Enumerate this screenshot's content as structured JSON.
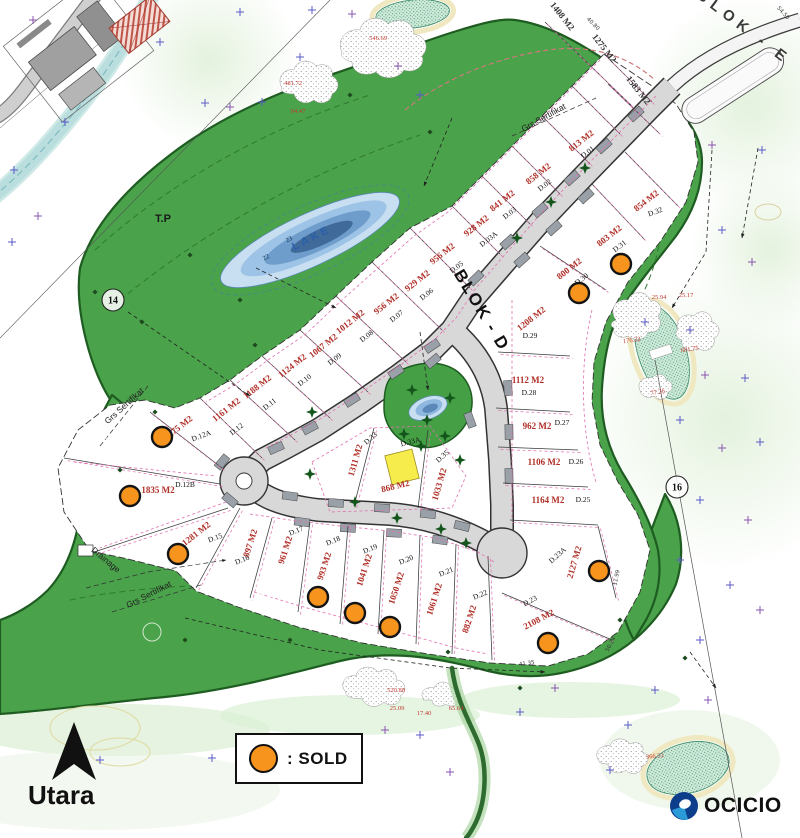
{
  "legend": {
    "sold_label": ": SOLD"
  },
  "compass": {
    "label": "Utara"
  },
  "brand": {
    "name": "OCICIO"
  },
  "map": {
    "colors": {
      "green": "#4aa24a",
      "green_dark": "#1e5c21",
      "road": "#d8d8d8",
      "sold": "#f7941d",
      "area_text": "#b03028",
      "pink": "#e070b0",
      "lake_deep": "#3f6a99",
      "building_yellow": "#f6ec4c",
      "cross_blue": "#5b5bc8",
      "cross_purple": "#8a55b0"
    },
    "labels": [
      {
        "t": "BLOK - D",
        "x": 477,
        "y": 313,
        "r": 59,
        "s": 17,
        "c": "#111",
        "w": 700,
        "ls": 2
      },
      {
        "t": "BLOK - E",
        "x": 741,
        "y": 31,
        "r": 37,
        "s": 15,
        "c": "#3a3a3a",
        "w": 700,
        "ls": 6
      },
      {
        "t": "LAKE",
        "x": 313,
        "y": 241,
        "r": -27,
        "s": 11,
        "c": "#2b5fa8",
        "w": 700,
        "ls": 3
      },
      {
        "t": "T.P",
        "x": 163,
        "y": 222,
        "r": 0,
        "s": 11,
        "c": "#1a1a1a",
        "w": 700,
        "ls": 0
      },
      {
        "t": "Grs Sertifikat",
        "x": 545,
        "y": 120,
        "r": -29,
        "s": 8.5,
        "c": "#222",
        "w": 400,
        "ls": 0
      },
      {
        "t": "Grs Sertifikat",
        "x": 126,
        "y": 408,
        "r": -42,
        "s": 8.5,
        "c": "#222",
        "w": 400,
        "ls": 0
      },
      {
        "t": "Grs Sertifikat",
        "x": 150,
        "y": 597,
        "r": -27,
        "s": 8.5,
        "c": "#222",
        "w": 400,
        "ls": 0
      },
      {
        "t": "Drainage",
        "x": 104,
        "y": 562,
        "r": 40,
        "s": 8.5,
        "c": "#222",
        "w": 400,
        "ls": 0
      }
    ],
    "plots": [
      {
        "id": "D.01",
        "area": "813 M2",
        "ax": 583,
        "ay": 143,
        "ar": -38,
        "ix": 589,
        "iy": 154,
        "ir": -38,
        "sold": false
      },
      {
        "id": "D.02",
        "area": "858 M2",
        "ax": 540,
        "ay": 176,
        "ar": -38,
        "ix": 546,
        "iy": 187,
        "ir": -38,
        "sold": false
      },
      {
        "id": "D.03",
        "area": "841 M2",
        "ax": 504,
        "ay": 203,
        "ar": -38,
        "ix": 511,
        "iy": 215,
        "ir": -38,
        "sold": false
      },
      {
        "id": "D.03A",
        "area": "928 M2",
        "ax": 478,
        "ay": 228,
        "ar": -38,
        "ix": 490,
        "iy": 241,
        "ir": -38,
        "sold": false
      },
      {
        "id": "D.05",
        "area": "956 M2",
        "ax": 444,
        "ay": 256,
        "ar": -38,
        "ix": 458,
        "iy": 269,
        "ir": -38,
        "sold": false
      },
      {
        "id": "D.06",
        "area": "929 M2",
        "ax": 419,
        "ay": 283,
        "ar": -38,
        "ix": 428,
        "iy": 296,
        "ir": -38,
        "sold": false
      },
      {
        "id": "D.07",
        "area": "956 M2",
        "ax": 388,
        "ay": 306,
        "ar": -38,
        "ix": 398,
        "iy": 318,
        "ir": -38,
        "sold": false
      },
      {
        "id": "D.08",
        "area": "1012 M2",
        "ax": 352,
        "ay": 324,
        "ar": -38,
        "ix": 368,
        "iy": 338,
        "ir": -38,
        "sold": false
      },
      {
        "id": "D.09",
        "area": "1067 M2",
        "ax": 325,
        "ay": 348,
        "ar": -38,
        "ix": 336,
        "iy": 361,
        "ir": -38,
        "sold": false
      },
      {
        "id": "D.10",
        "area": "1124 M2",
        "ax": 294,
        "ay": 368,
        "ar": -38,
        "ix": 306,
        "iy": 382,
        "ir": -38,
        "sold": false
      },
      {
        "id": "D.11",
        "area": "1188 M2",
        "ax": 259,
        "ay": 389,
        "ar": -38,
        "ix": 271,
        "iy": 406,
        "ir": -38,
        "sold": false
      },
      {
        "id": "D.12",
        "area": "1161 M2",
        "ax": 228,
        "ay": 412,
        "ar": -38,
        "ix": 238,
        "iy": 431,
        "ir": -38,
        "sold": false
      },
      {
        "id": "D.12A",
        "area": "1275 M2",
        "ax": 180,
        "ay": 430,
        "ar": -38,
        "ix": 202,
        "iy": 438,
        "ir": -20,
        "sold": true,
        "sx": 162,
        "sy": 437
      },
      {
        "id": "D.12B",
        "area": "1835 M2",
        "ax": 158,
        "ay": 493,
        "ar": 0,
        "ix": 185,
        "iy": 487,
        "ir": 0,
        "sold": true,
        "sx": 130,
        "sy": 496
      },
      {
        "id": "D.15",
        "area": "1281 M2",
        "ax": 198,
        "ay": 536,
        "ar": -38,
        "ix": 216,
        "iy": 540,
        "ir": -20,
        "sold": true,
        "sx": 178,
        "sy": 554
      },
      {
        "id": "D.16",
        "area": "897 M2",
        "ax": 253,
        "ay": 544,
        "ar": -72,
        "ix": 243,
        "iy": 562,
        "ir": -22,
        "sold": false
      },
      {
        "id": "D.17",
        "area": "961 M2",
        "ax": 288,
        "ay": 551,
        "ar": -72,
        "ix": 297,
        "iy": 533,
        "ir": -22,
        "sold": false
      },
      {
        "id": "D.18",
        "area": "993 M2",
        "ax": 327,
        "ay": 567,
        "ar": -72,
        "ix": 334,
        "iy": 543,
        "ir": -22,
        "sold": true,
        "sx": 318,
        "sy": 597
      },
      {
        "id": "D.19",
        "area": "1041 M2",
        "ax": 367,
        "ay": 571,
        "ar": -72,
        "ix": 371,
        "iy": 551,
        "ir": -22,
        "sold": true,
        "sx": 355,
        "sy": 613
      },
      {
        "id": "D.20",
        "area": "1050 M2",
        "ax": 399,
        "ay": 589,
        "ar": -72,
        "ix": 407,
        "iy": 562,
        "ir": -22,
        "sold": true,
        "sx": 390,
        "sy": 627
      },
      {
        "id": "D.21",
        "area": "1061 M2",
        "ax": 437,
        "ay": 600,
        "ar": -72,
        "ix": 447,
        "iy": 574,
        "ir": -22,
        "sold": false
      },
      {
        "id": "D.22",
        "area": "882 M2",
        "ax": 472,
        "ay": 620,
        "ar": -72,
        "ix": 481,
        "iy": 597,
        "ir": -22,
        "sold": false
      },
      {
        "id": "D.23",
        "area": "2108 M2",
        "ax": 540,
        "ay": 622,
        "ar": -28,
        "ix": 531,
        "iy": 603,
        "ir": -28,
        "sold": true,
        "sx": 548,
        "sy": 643
      },
      {
        "id": "D.23A",
        "area": "2127 M2",
        "ax": 577,
        "ay": 563,
        "ar": -74,
        "ix": 559,
        "iy": 557,
        "ir": -42,
        "sold": true,
        "sx": 599,
        "sy": 571
      },
      {
        "id": "D.25",
        "area": "1164 M2",
        "ax": 548,
        "ay": 503,
        "ar": 0,
        "ix": 583,
        "iy": 502,
        "ir": 0,
        "sold": false
      },
      {
        "id": "D.26",
        "area": "1106 M2",
        "ax": 544,
        "ay": 465,
        "ar": 0,
        "ix": 576,
        "iy": 464,
        "ir": 0,
        "sold": false
      },
      {
        "id": "D.27",
        "area": "962 M2",
        "ax": 537,
        "ay": 429,
        "ar": 0,
        "ix": 562,
        "iy": 425,
        "ir": 0,
        "sold": false
      },
      {
        "id": "D.28",
        "area": "1112 M2",
        "ax": 528,
        "ay": 383,
        "ar": 0,
        "ix": 529,
        "iy": 395,
        "ir": 0,
        "sold": false
      },
      {
        "id": "D.29",
        "area": "1208 M2",
        "ax": 533,
        "ay": 321,
        "ar": -38,
        "ix": 530,
        "iy": 338,
        "ir": 0,
        "sold": false
      },
      {
        "id": "D.30",
        "area": "800 M2",
        "ax": 571,
        "ay": 271,
        "ar": -38,
        "ix": 583,
        "iy": 281,
        "ir": -38,
        "sold": true,
        "sx": 579,
        "sy": 293
      },
      {
        "id": "D.31",
        "area": "803 M2",
        "ax": 611,
        "ay": 238,
        "ar": -38,
        "ix": 621,
        "iy": 248,
        "ir": -38,
        "sold": true,
        "sx": 621,
        "sy": 264
      },
      {
        "id": "D.32",
        "area": "854 M2",
        "ax": 648,
        "ay": 203,
        "ar": -38,
        "ix": 656,
        "iy": 214,
        "ir": -20,
        "sold": false
      },
      {
        "id": "D.33",
        "area": "1311 M2",
        "ax": 358,
        "ay": 461,
        "ar": -74,
        "ix": 372,
        "iy": 440,
        "ir": -42,
        "sold": false
      },
      {
        "id": "D.33A",
        "area": "868 M2",
        "ax": 396,
        "ay": 489,
        "ar": -14,
        "ix": 411,
        "iy": 444,
        "ir": -14,
        "sold": false
      },
      {
        "id": "D.35",
        "area": "1033 M2",
        "ax": 442,
        "ay": 485,
        "ar": -74,
        "ix": 444,
        "iy": 458,
        "ir": -42,
        "sold": false
      }
    ],
    "blok_e_plots": [
      {
        "area": "1408 M2",
        "x": 560,
        "y": 18,
        "r": 52
      },
      {
        "area": "1275 M2",
        "x": 602,
        "y": 50,
        "r": 52
      },
      {
        "area": "1583 M2",
        "x": 636,
        "y": 92,
        "r": 52
      }
    ],
    "red_numbers": [
      {
        "t": "546.69",
        "x": 378,
        "y": 40,
        "r": 0
      },
      {
        "t": "481.72",
        "x": 293,
        "y": 85,
        "r": 0
      },
      {
        "t": "94.47",
        "x": 298,
        "y": 113,
        "r": 0
      },
      {
        "t": "25.94",
        "x": 659,
        "y": 299,
        "r": 0
      },
      {
        "t": "25.17",
        "x": 686,
        "y": 297,
        "r": 0
      },
      {
        "t": "176.22",
        "x": 632,
        "y": 342,
        "r": -8
      },
      {
        "t": "681.75",
        "x": 690,
        "y": 351,
        "r": -8
      },
      {
        "t": "77.26",
        "x": 658,
        "y": 394,
        "r": -10
      },
      {
        "t": "520.88",
        "x": 396,
        "y": 692,
        "r": 0
      },
      {
        "t": "25.09",
        "x": 397,
        "y": 710,
        "r": 0
      },
      {
        "t": "17.40",
        "x": 424,
        "y": 715,
        "r": 0
      },
      {
        "t": "65.64",
        "x": 456,
        "y": 710,
        "r": 0
      },
      {
        "t": "366.53",
        "x": 655,
        "y": 758,
        "r": -5
      }
    ],
    "small_dims": [
      {
        "t": "40.80",
        "x": 592,
        "y": 25,
        "r": 45
      },
      {
        "t": "54.50",
        "x": 782,
        "y": 14,
        "r": 48
      },
      {
        "t": "41.35",
        "x": 527,
        "y": 665,
        "r": -8
      },
      {
        "t": "50.24",
        "x": 612,
        "y": 645,
        "r": -62
      },
      {
        "t": "11.99",
        "x": 618,
        "y": 578,
        "r": -78
      }
    ],
    "circled_numbers": [
      {
        "t": "14",
        "x": 113,
        "y": 300
      },
      {
        "t": "16",
        "x": 677,
        "y": 487
      }
    ],
    "contour_numbers": [
      {
        "t": "22",
        "x": 267,
        "y": 259,
        "r": -28
      },
      {
        "t": "23",
        "x": 290,
        "y": 241,
        "r": -28
      }
    ],
    "boundary_lines": [
      [
        652,
        102,
        604,
        54
      ],
      [
        620,
        134,
        572,
        86
      ],
      [
        590,
        164,
        542,
        116
      ],
      [
        560,
        194,
        512,
        146
      ],
      [
        530,
        224,
        482,
        176
      ],
      [
        500,
        254,
        452,
        206
      ],
      [
        470,
        288,
        410,
        228
      ],
      [
        442,
        330,
        372,
        262
      ],
      [
        406,
        362,
        336,
        296
      ],
      [
        368,
        392,
        300,
        330
      ],
      [
        330,
        418,
        262,
        356
      ],
      [
        295,
        440,
        230,
        380
      ],
      [
        262,
        458,
        200,
        398
      ],
      [
        222,
        468,
        150,
        412
      ],
      [
        220,
        484,
        64,
        458
      ],
      [
        228,
        508,
        94,
        552
      ],
      [
        240,
        508,
        196,
        588
      ],
      [
        272,
        518,
        250,
        598
      ],
      [
        310,
        522,
        298,
        612
      ],
      [
        348,
        526,
        340,
        624
      ],
      [
        384,
        530,
        378,
        634
      ],
      [
        420,
        535,
        416,
        644
      ],
      [
        456,
        544,
        452,
        654
      ],
      [
        488,
        556,
        492,
        660
      ],
      [
        625,
        152,
        678,
        206
      ],
      [
        592,
        184,
        645,
        240
      ],
      [
        540,
        246,
        606,
        290
      ],
      [
        498,
        352,
        570,
        356
      ],
      [
        496,
        408,
        570,
        412
      ],
      [
        498,
        447,
        578,
        450
      ],
      [
        503,
        483,
        588,
        487
      ],
      [
        510,
        520,
        598,
        525
      ],
      [
        502,
        593,
        612,
        640
      ],
      [
        598,
        526,
        616,
        598
      ],
      [
        374,
        428,
        354,
        506
      ],
      [
        428,
        430,
        418,
        508
      ],
      [
        545,
        22,
        600,
        75
      ],
      [
        577,
        53,
        632,
        106
      ],
      [
        608,
        84,
        660,
        134
      ]
    ],
    "road_pads": [
      [
        636,
        114,
        -42
      ],
      [
        604,
        146,
        -42
      ],
      [
        572,
        178,
        -42
      ],
      [
        540,
        210,
        -42
      ],
      [
        508,
        242,
        -42
      ],
      [
        476,
        278,
        -44
      ],
      [
        586,
        196,
        -42
      ],
      [
        554,
        228,
        -42
      ],
      [
        522,
        260,
        -42
      ],
      [
        432,
        346,
        -34
      ],
      [
        396,
        372,
        -34
      ],
      [
        352,
        400,
        -32
      ],
      [
        310,
        428,
        -28
      ],
      [
        276,
        448,
        -24
      ],
      [
        290,
        496,
        8
      ],
      [
        336,
        503,
        4
      ],
      [
        382,
        508,
        3
      ],
      [
        428,
        514,
        6
      ],
      [
        462,
        526,
        14
      ],
      [
        302,
        522,
        8
      ],
      [
        348,
        528,
        4
      ],
      [
        394,
        533,
        3
      ],
      [
        440,
        540,
        8
      ],
      [
        508,
        388,
        86
      ],
      [
        509,
        432,
        89
      ],
      [
        509,
        476,
        89
      ],
      [
        222,
        462,
        -50
      ],
      [
        230,
        500,
        40
      ],
      [
        433,
        361,
        -40
      ],
      [
        470,
        420,
        70
      ]
    ],
    "trees": [
      [
        585,
        168
      ],
      [
        551,
        202
      ],
      [
        517,
        238
      ],
      [
        312,
        412
      ],
      [
        427,
        420
      ],
      [
        445,
        436
      ],
      [
        421,
        446
      ],
      [
        310,
        474
      ],
      [
        355,
        502
      ],
      [
        397,
        518
      ],
      [
        441,
        529
      ],
      [
        466,
        543
      ],
      [
        412,
        390
      ],
      [
        450,
        398
      ],
      [
        404,
        434
      ],
      [
        460,
        460
      ]
    ],
    "crosses": [
      [
        33,
        20
      ],
      [
        240,
        12
      ],
      [
        312,
        10
      ],
      [
        352,
        14
      ],
      [
        160,
        42
      ],
      [
        300,
        57
      ],
      [
        398,
        66
      ],
      [
        262,
        102
      ],
      [
        205,
        103
      ],
      [
        230,
        107
      ],
      [
        65,
        122
      ],
      [
        14,
        170
      ],
      [
        38,
        216
      ],
      [
        12,
        242
      ],
      [
        420,
        95
      ],
      [
        712,
        145
      ],
      [
        762,
        150
      ],
      [
        722,
        230
      ],
      [
        752,
        262
      ],
      [
        645,
        322
      ],
      [
        690,
        330
      ],
      [
        705,
        375
      ],
      [
        745,
        378
      ],
      [
        680,
        420
      ],
      [
        722,
        448
      ],
      [
        760,
        442
      ],
      [
        700,
        500
      ],
      [
        748,
        520
      ],
      [
        680,
        560
      ],
      [
        730,
        585
      ],
      [
        760,
        610
      ],
      [
        700,
        640
      ],
      [
        655,
        690
      ],
      [
        708,
        700
      ],
      [
        628,
        725
      ],
      [
        100,
        760
      ],
      [
        385,
        730
      ],
      [
        420,
        735
      ],
      [
        520,
        712
      ],
      [
        555,
        688
      ],
      [
        610,
        770
      ],
      [
        212,
        758
      ],
      [
        450,
        772
      ]
    ],
    "diamonds": [
      [
        190,
        255
      ],
      [
        255,
        345
      ],
      [
        155,
        412
      ],
      [
        120,
        470
      ],
      [
        290,
        640
      ],
      [
        185,
        640
      ],
      [
        520,
        688
      ],
      [
        620,
        620
      ],
      [
        685,
        658
      ],
      [
        350,
        95
      ],
      [
        430,
        132
      ],
      [
        95,
        292
      ],
      [
        142,
        322
      ],
      [
        240,
        300
      ],
      [
        448,
        652
      ]
    ],
    "rings": [
      [
        108,
        447,
        9
      ],
      [
        268,
        586,
        11
      ],
      [
        152,
        632,
        9
      ]
    ]
  }
}
